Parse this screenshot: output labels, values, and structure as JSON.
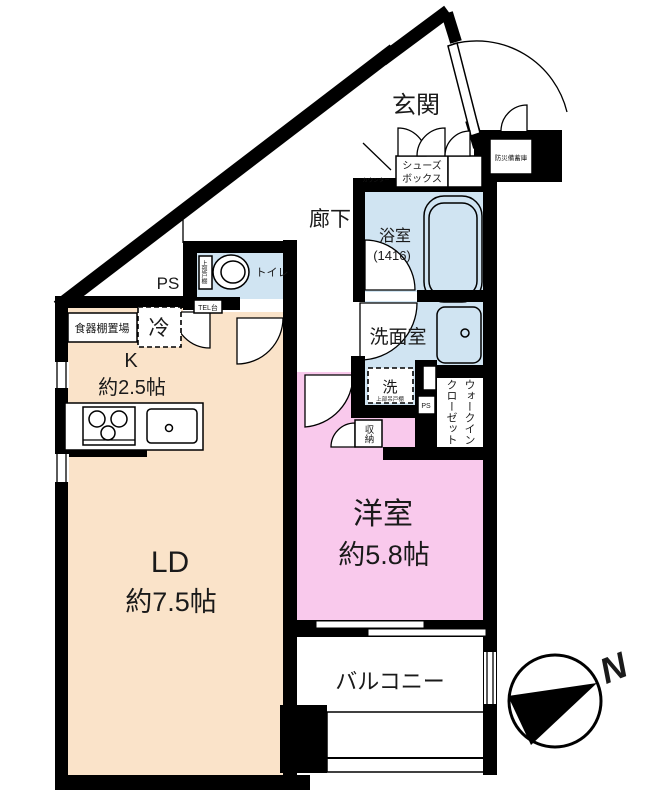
{
  "labels": {
    "genkan": "玄関",
    "hallway": "廊下",
    "shoes1": "シューズ",
    "shoes2": "ボックス",
    "counter_note": "カウンター",
    "disaster": "防災備蓄庫",
    "bath": "浴室",
    "bath_size": "(1416)",
    "toilet": "トイレ",
    "toilet_shelf": "上部戸棚",
    "ps": "PS",
    "tel": "TEL台",
    "dish_shelf": "食器棚置場",
    "fridge": "冷",
    "kitchen": "K",
    "kitchen_size": "約2.5帖",
    "washroom": "洗面室",
    "washer": "洗",
    "washer_shelf": "上部吊戸棚",
    "ps2": "PS",
    "wic1": "ウォークイン",
    "wic2": "クローゼット",
    "storage": "収納",
    "bedroom": "洋室",
    "bedroom_size": "約5.8帖",
    "living": "LD",
    "living_size": "約7.5帖",
    "balcony": "バルコニー",
    "north": "N"
  },
  "colors": {
    "wall": "#000000",
    "living_floor": "#fae3c9",
    "bedroom_floor": "#f9c9ec",
    "wet_floor": "#d0e4f2"
  }
}
